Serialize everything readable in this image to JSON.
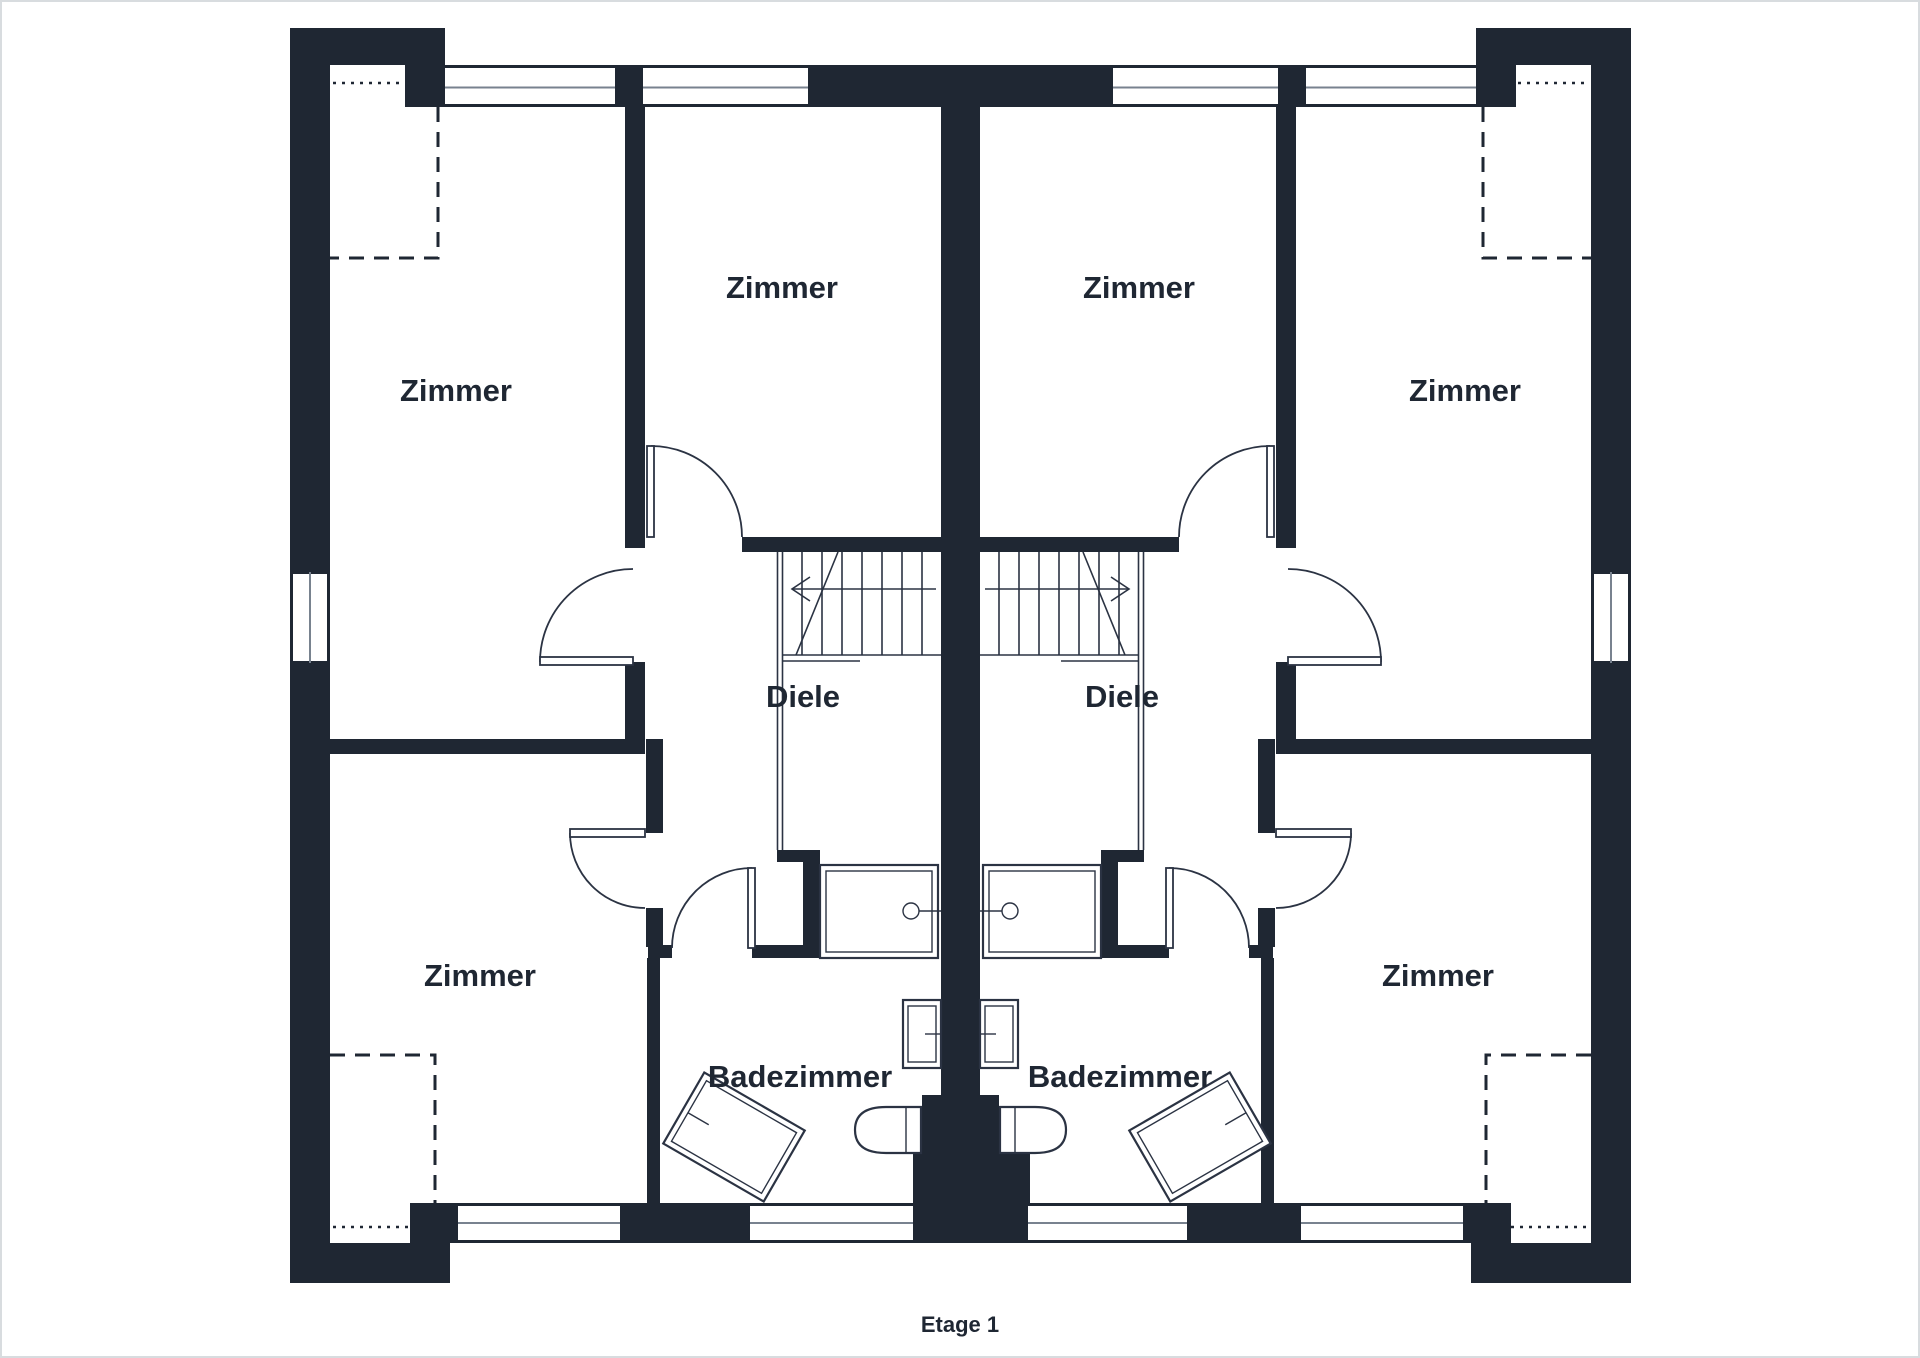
{
  "title": "Etage 1",
  "colors": {
    "wall": "#1f2733",
    "line": "#2b3343",
    "glass": "#78828f",
    "frame": "#d8dcdf",
    "bg": "#ffffff"
  },
  "rooms": [
    {
      "id": "zimmer-upper-left",
      "label": "Zimmer"
    },
    {
      "id": "zimmer-mid-left",
      "label": "Zimmer"
    },
    {
      "id": "zimmer-mid-right",
      "label": "Zimmer"
    },
    {
      "id": "zimmer-upper-right",
      "label": "Zimmer"
    },
    {
      "id": "diele-left",
      "label": "Diele"
    },
    {
      "id": "diele-right",
      "label": "Diele"
    },
    {
      "id": "zimmer-lower-left",
      "label": "Zimmer"
    },
    {
      "id": "zimmer-lower-right",
      "label": "Zimmer"
    },
    {
      "id": "bad-left",
      "label": "Badezimmer"
    },
    {
      "id": "bad-right",
      "label": "Badezimmer"
    }
  ],
  "fixtures": {
    "left_bathroom": [
      "shower",
      "washbasin",
      "toilet",
      "bathtub-angled"
    ],
    "right_bathroom": [
      "shower",
      "washbasin",
      "toilet",
      "bathtub-angled"
    ]
  },
  "stairs": [
    "stairs-left-unit",
    "stairs-right-unit"
  ]
}
